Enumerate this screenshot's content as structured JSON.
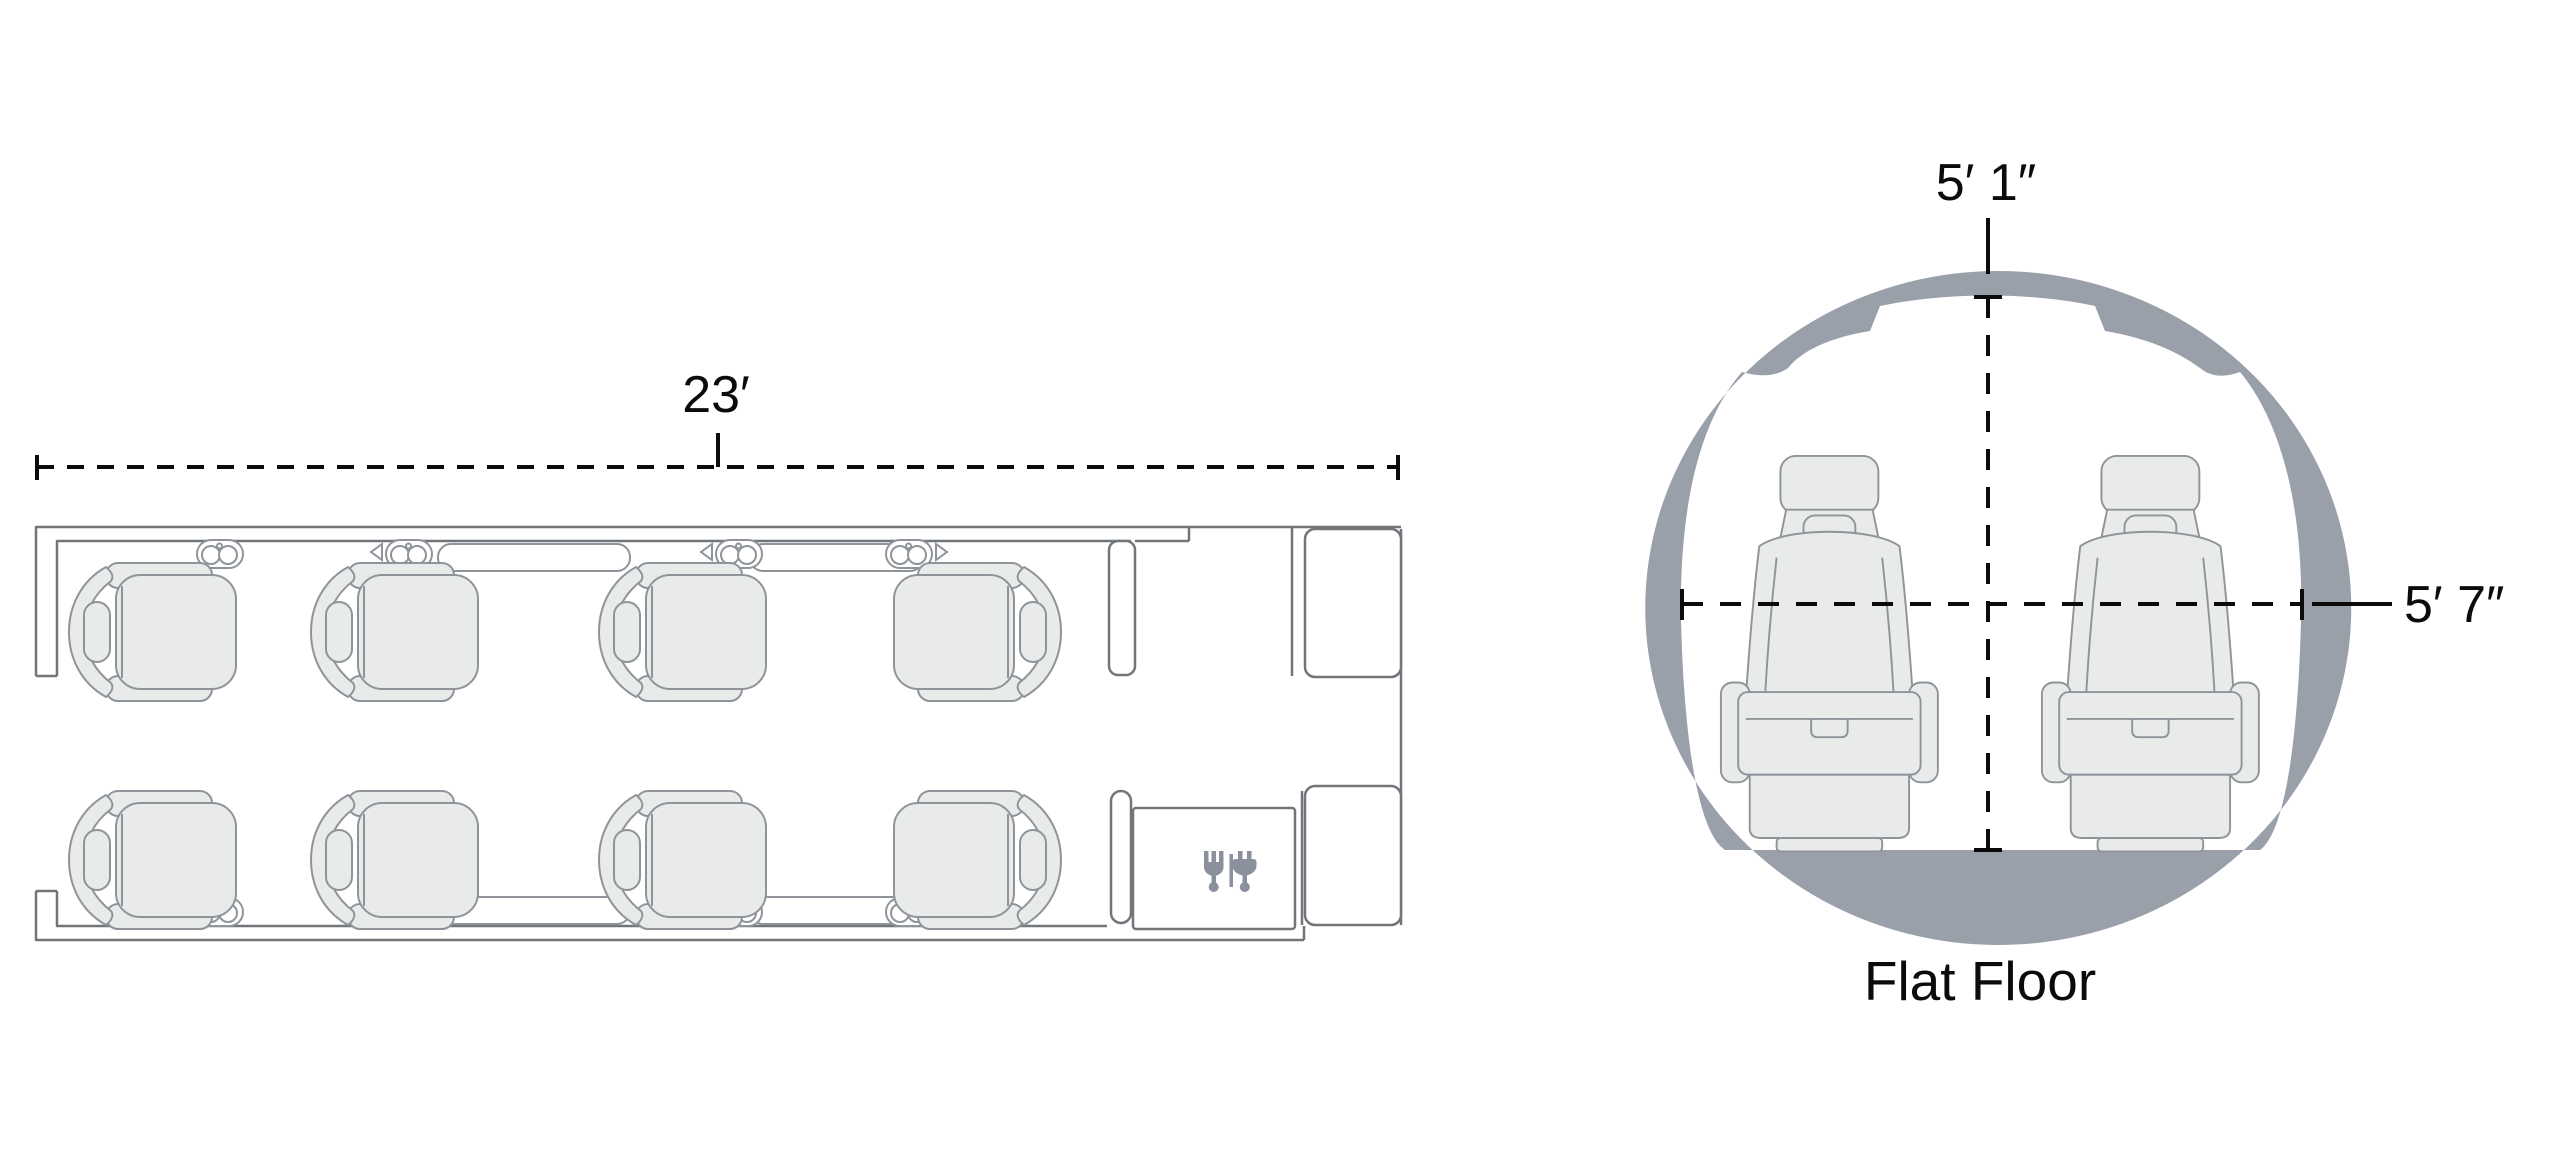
{
  "title": "Aircraft cabin configuration diagram",
  "floorplan": {
    "length_label": "23′",
    "seat_count": 8,
    "seat_rows": 2,
    "seats_per_row": 4,
    "icons": {
      "galley": "fork-and-plug-icon",
      "cupholder": "twin-cupholder-icon"
    }
  },
  "cross_section": {
    "height_label": "5′ 1″",
    "width_label": "5′ 7″",
    "caption": "Flat Floor",
    "seat_count": 2
  },
  "colors": {
    "fuselage_gray": "#99a0aa",
    "seat_fill": "#e9eaea",
    "seat_line": "#8f949a",
    "wall_line": "#71767b",
    "icon_gray": "#8a919c",
    "text": "#0b0b0b",
    "background": "#ffffff"
  }
}
